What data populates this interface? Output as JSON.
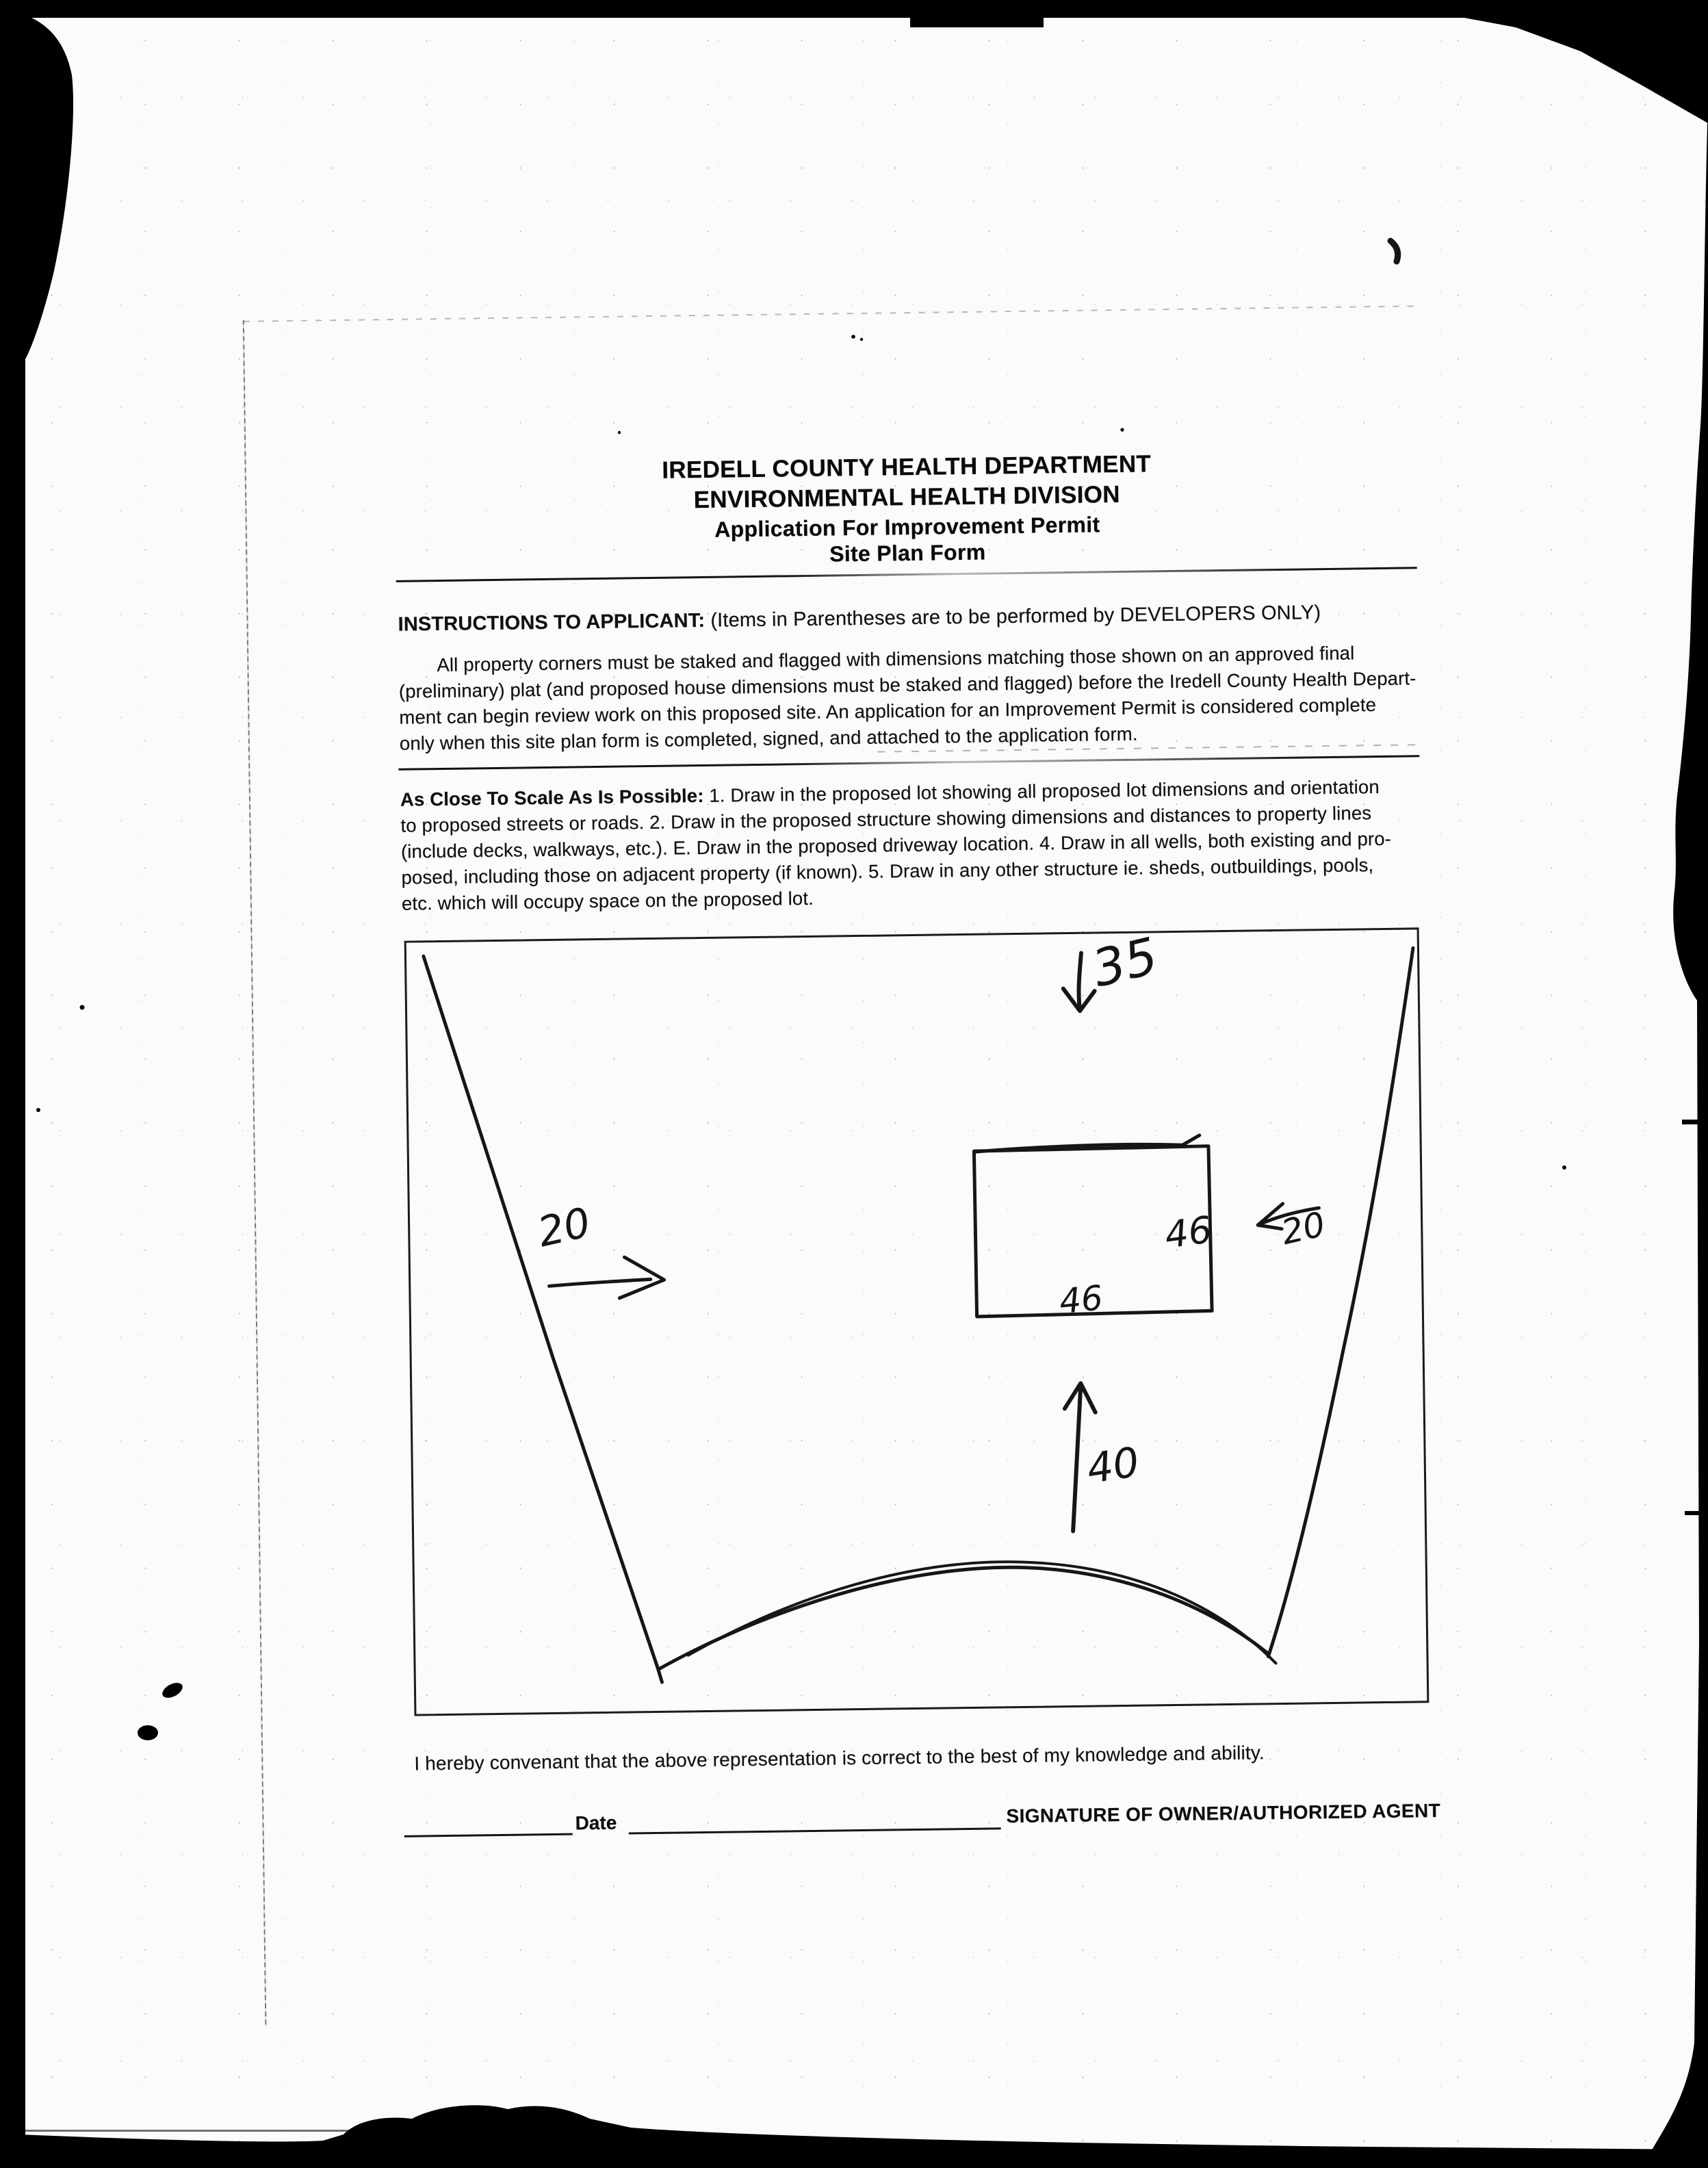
{
  "page": {
    "header": {
      "lines": [
        "IREDELL COUNTY HEALTH DEPARTMENT",
        "ENVIRONMENTAL HEALTH DIVISION",
        "Application For Improvement Permit",
        "Site Plan Form"
      ]
    },
    "instructions": {
      "lead": "INSTRUCTIONS TO APPLICANT:",
      "lead_rest": " (Items in Parentheses are to be performed by DEVELOPERS ONLY)",
      "lines": [
        "All property corners must be staked and flagged with dimensions matching those shown on an approved final",
        "(preliminary) plat (and proposed house dimensions must be staked and flagged) before the Iredell County Health Depart-",
        "ment can begin review work on this proposed site. An application for an Improvement Permit is considered complete",
        "only when this site plan form is completed, signed, and attached to the application form."
      ]
    },
    "scale_note": {
      "lead": "As Close To Scale As Is Possible:",
      "line0_rest": " 1. Draw in the proposed lot showing all proposed lot dimensions and orientation",
      "lines": [
        "to proposed streets or roads. 2. Draw in the proposed structure showing dimensions and distances to property lines",
        "(include decks, walkways, etc.). E. Draw in the proposed driveway location. 4. Draw in all wells, both existing and pro-",
        "posed, including those on adjacent property (if known). 5. Draw in any other structure ie. sheds, outbuildings, pools,",
        "etc. which will occupy space on the proposed lot."
      ]
    },
    "site_plan": {
      "labels": {
        "top_setback": "35",
        "left_setback": "20",
        "right_setback": "20",
        "front_distance": "40",
        "house_depth": "46",
        "house_width": "46"
      }
    },
    "covenant": "I hereby convenant that the above representation is correct to the best of my knowledge and ability.",
    "signature": {
      "date_label": "Date",
      "agent_label": "SIGNATURE OF OWNER/AUTHORIZED AGENT"
    }
  }
}
